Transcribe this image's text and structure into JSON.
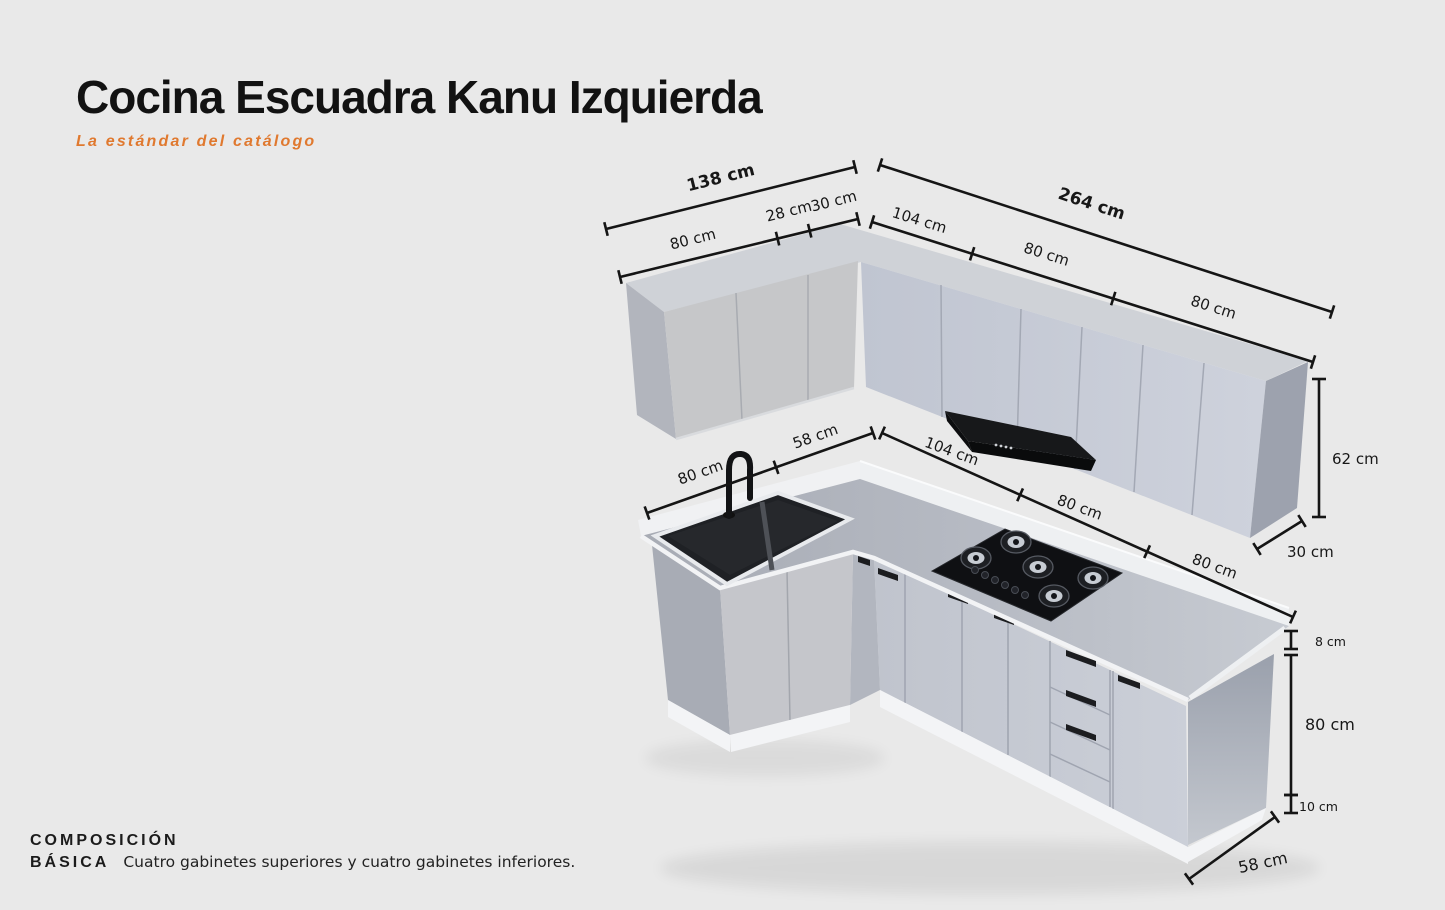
{
  "page": {
    "background_color": "#e9e9e9"
  },
  "header": {
    "title": "Cocina Escuadra Kanu Izquierda",
    "subtitle": "La estándar del catálogo",
    "accent_color": "#E0792F"
  },
  "footer": {
    "heading_line1": "COMPOSICIÓN",
    "heading_line2": "BÁSICA",
    "description": "Cuatro gabinetes superiores y cuatro gabinetes inferiores."
  },
  "diagram": {
    "upper_total_left": "138 cm",
    "upper_left_segments": [
      "80 cm",
      "28 cm",
      "30 cm"
    ],
    "upper_total_right": "264 cm",
    "upper_right_segments": [
      "104 cm",
      "80 cm",
      "80 cm"
    ],
    "counter_left_segments": [
      "80 cm",
      "58 cm"
    ],
    "counter_right_segments": [
      "104 cm",
      "80 cm",
      "80 cm"
    ],
    "upper_cabinet_height": "62 cm",
    "upper_cabinet_depth": "30 cm",
    "backsplash_height": "8 cm",
    "base_cabinet_height": "80 cm",
    "plinth_height": "10 cm",
    "base_cabinet_depth": "58 cm"
  }
}
